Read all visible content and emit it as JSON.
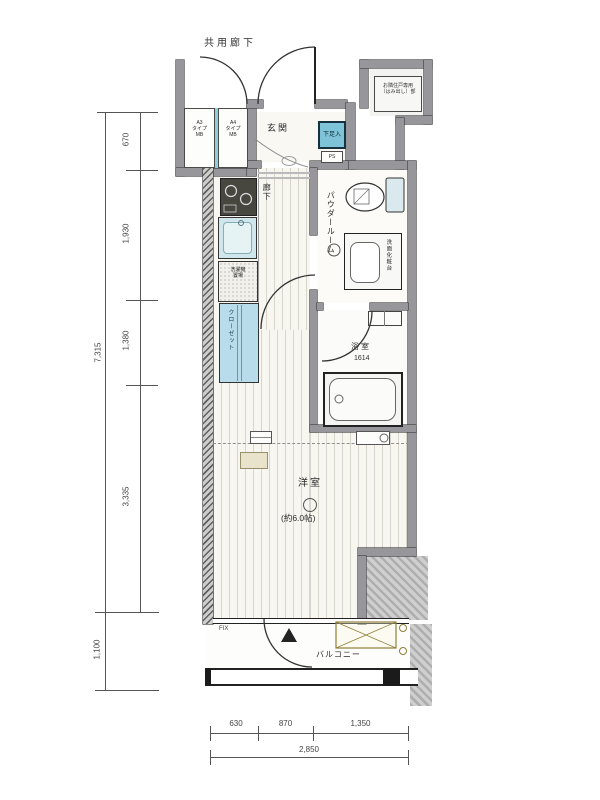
{
  "plan": {
    "corridor_label": "共用廊下",
    "entrance_label": "玄関",
    "shoe_box_label": "下足入",
    "ps_label": "PS",
    "hallway_label": "廊下",
    "mb_left": {
      "l1": "A3",
      "l2": "タイプ",
      "l3": "MB"
    },
    "mb_right": {
      "l1": "A4",
      "l2": "タイプ",
      "l3": "MB"
    },
    "note": {
      "l1": "お隣住戸専用",
      "l2": "（はみ出し）部"
    },
    "washer": {
      "l1": "洗濯機",
      "l2": "置場"
    },
    "closet_label": "クローゼット",
    "powder_label": "パウダールーム",
    "vanity_label": "洗面化粧台",
    "bath_label": "浴室",
    "bath_size": "1614",
    "bedroom_label": "洋室",
    "bedroom_size": "(約6.0帖)",
    "balcony_label": "バルコニー",
    "fix_label": "FIX"
  },
  "dimensions": {
    "left_segments": [
      "670",
      "1,930",
      "1,380",
      "3,335"
    ],
    "left_total": "7,315",
    "left_lower": "1,100",
    "bottom_segments": [
      "630",
      "870",
      "1,350"
    ],
    "bottom_total": "2,850"
  },
  "colors": {
    "wall": "#97979b",
    "fixture_blue": "#cfe7ec",
    "closet_blue": "#b9dcea",
    "shoe_box_blue": "#7ec3d8",
    "hatch_olive": "#8f7f3a",
    "floor_stripe": "#d8d5ca"
  }
}
